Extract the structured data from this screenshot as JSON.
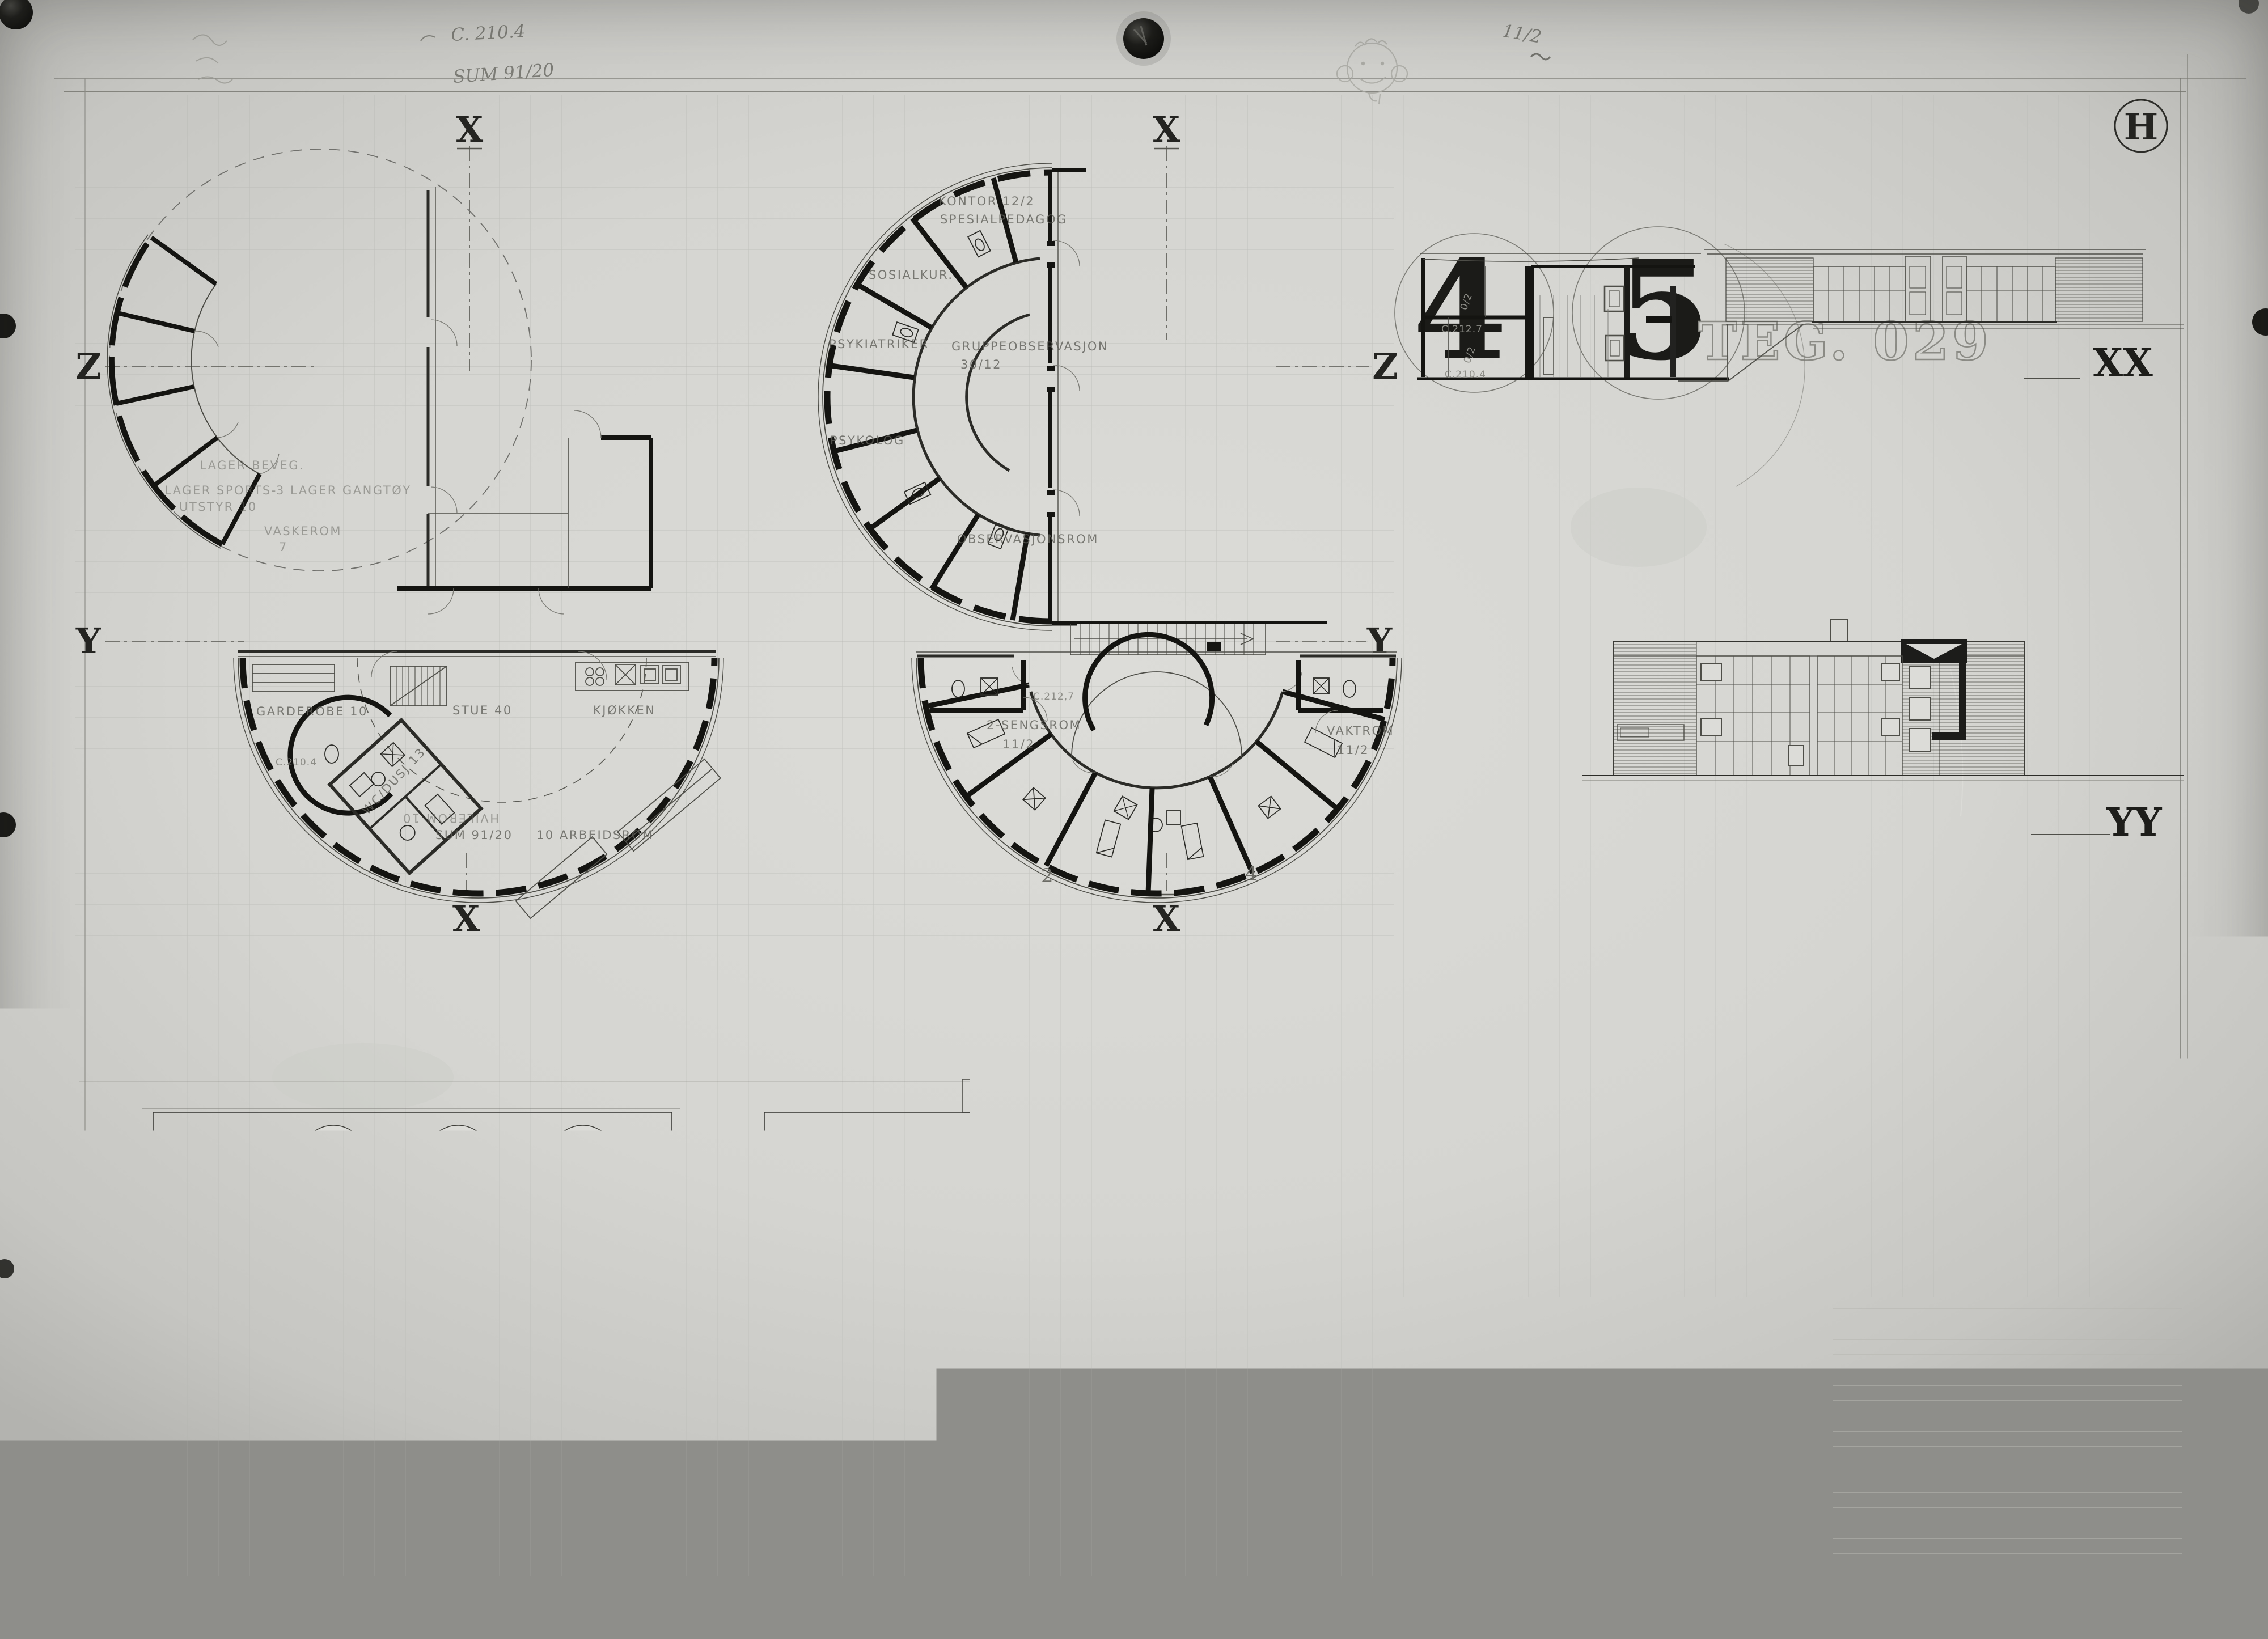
{
  "sheet": {
    "letter_mark": "H"
  },
  "stamps": {
    "big_left": "4",
    "big_right": "5",
    "teg": "TEG. 029"
  },
  "axes": {
    "x": "X",
    "y": "Y",
    "z": "Z",
    "xx": "XX",
    "yy": "YY",
    "zz": "ZZ"
  },
  "handwriting": {
    "level_note": "C. 210.4",
    "sum_note": "SUM 91/20",
    "fraction_note": "11/2"
  },
  "plans": {
    "storage": {
      "rooms": [
        "LAGER BEVEG.",
        "LAGER SPORTS-",
        "UTSTYR 10",
        "3 LAGER GANGTØY",
        "VASKEROM",
        "7"
      ]
    },
    "admin": {
      "rooms": [
        "KONTOR 12/2",
        "SPESIALPEDAGOG",
        "SOSIALKUR.",
        "PSYKIATRIKER",
        "PSYKOLOG",
        "GRUPPEOBSERVASJON",
        "30/12",
        "OBSERVASJONSROM"
      ]
    },
    "living": {
      "rooms": [
        "GARDEROBE 10",
        "STUE 40",
        "KJØKKEN",
        "WC/DUSJ 13",
        "SUM 91/20",
        "10 ARBEIDSROM",
        "HVILEROM 10"
      ],
      "level": "C.210.4"
    },
    "sleeping": {
      "rooms": [
        "2-SENGSROM",
        "11/2",
        "VAKTROM",
        "11/2"
      ],
      "level": "C.212,7",
      "room_numbers": [
        "2",
        "4"
      ]
    }
  },
  "section": {
    "notes": [
      "0/2",
      "C.212.7",
      "0/2",
      "C.210.4"
    ]
  },
  "facades": {
    "west": "FASADE MOT VEST",
    "north": "FASADE MOT NORD"
  },
  "titleblock": {
    "revision_label": "RETTET :",
    "dates": [
      "20 JAN. 1971",
      "27 JAN. 1971",
      "22 FEB. 1971"
    ],
    "drawing_number": "SK 024",
    "project_lines": [
      "SKÅDALEN OFF. SKOLE FOR DØVE",
      "OBSERVASJONSAVD. MED INTERNAT",
      "PLANER SNITT FASADER MÅL 1:100",
      "OSLO 30 NOVEMBER 1970"
    ],
    "signature": "Sverre Fehn.",
    "credit": "SVERRE FEHN ARK. MNAL T.444476"
  }
}
